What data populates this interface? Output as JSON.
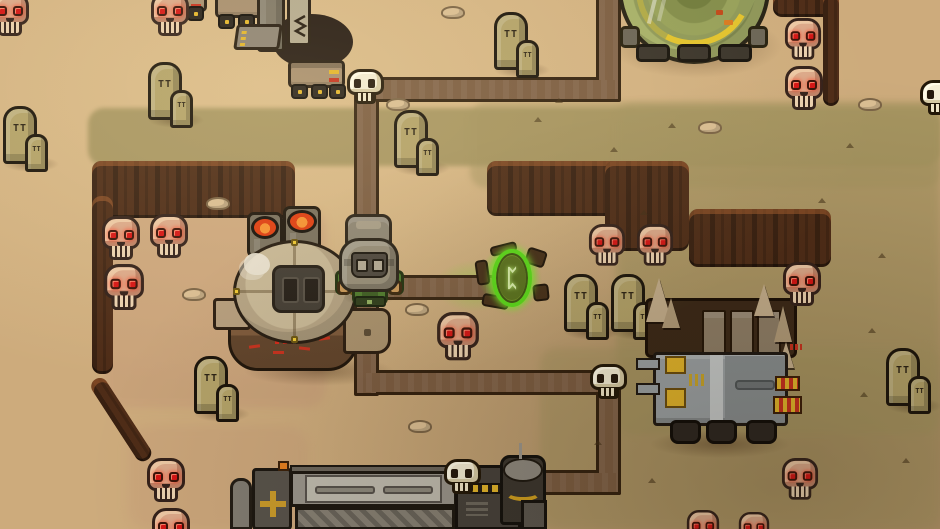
{
  "meta": {
    "width": 940,
    "height": 529
  },
  "palette": {
    "sand": "#cdab7c",
    "sand_hi": "#e2c491",
    "olive": "#a4935f",
    "pit": "#c59a78",
    "cliff": "#4e2c17",
    "cliff_edge": "#92542c",
    "path_fill": "#7b5c41",
    "path_edge": "#33210f",
    "bone": "#f3ecd4",
    "skull_pink": "#dba889",
    "skull_shade": "#bd8468",
    "skull_hi": "#ecc7a4",
    "eye_red": "#d41414",
    "outline": "#33211a",
    "stone": "#b2a168",
    "green_armor": "#4c7a2c",
    "glove": "#c89758",
    "helmet": "#958c78",
    "helmet_dark": "#4c463e",
    "lens": "#b2a995",
    "portal_green": "#58d818",
    "portal_mid": "#6f8c26",
    "portal_inner": "#57701c",
    "rune_pale": "#d6edaa",
    "rock_brown": "#432d17",
    "lava_red": "#dd3c10",
    "lava_orange": "#f59030",
    "yellow": "#e2b42a",
    "orange": "#e57f1f",
    "red_mark": "#c5301d",
    "tan_truck": "#a68d6e",
    "wheel": "#27211b",
    "metal": "#7e7666",
    "metal_light": "#b3a98f",
    "grey_cab": "#9aa0a3",
    "grey_light": "#c5c9c9",
    "grey_mid": "#878d8f",
    "bed_brown": "#3a2817",
    "plank": "#8d7d66",
    "spike_tan": "#c3ad8b",
    "dome_green": "#8e9858",
    "dome_light": "#a6b068",
    "tread": "#39332a",
    "factory_dark": "#57524a",
    "factory_panel": "#98938a",
    "factory_light": "#bdb9ad"
  },
  "portal": {
    "rune_glyph": "ᛈ"
  },
  "decor": {
    "gravestone_mark": "TT",
    "gravestone_mark_small": "TT"
  },
  "layout": {
    "mining-machine": {
      "x": 185,
      "y": 0
    },
    "dome-structure": {
      "x": 618,
      "y": -88
    },
    "incinerator-furnace": {
      "x": 213,
      "y": 203
    },
    "armored-truck": {
      "x": 638,
      "y": 292
    },
    "workshop-building": {
      "x": 228,
      "y": 455
    },
    "player-character": {
      "x": 331,
      "y": 212
    },
    "green-portal": {
      "x": 468,
      "y": 236
    }
  },
  "scene": {
    "terrain": {
      "olive_patches": [
        {
          "x": 88,
          "y": 108,
          "w": 852,
          "h": 58,
          "op": 0.92,
          "blur": 2
        },
        {
          "x": 470,
          "y": 102,
          "w": 470,
          "h": 86,
          "op": 0.5,
          "blur": 3
        },
        {
          "x": 616,
          "y": 104,
          "w": 324,
          "h": 330,
          "op": 0.68,
          "blur": 4
        },
        {
          "x": 540,
          "y": 348,
          "w": 400,
          "h": 181,
          "op": 0.5,
          "blur": 4
        }
      ],
      "pit_tints": [
        {
          "x": 104,
          "y": 208,
          "w": 222,
          "h": 200,
          "op": 0.5,
          "blur": 4
        },
        {
          "x": 128,
          "y": 426,
          "w": 180,
          "h": 103,
          "op": 0.35,
          "blur": 5
        }
      ],
      "cliffs": [
        {
          "x": 92,
          "y": 161,
          "w": 203,
          "h": 57
        },
        {
          "x": 92,
          "y": 196,
          "w": 21,
          "h": 178
        },
        {
          "x": 487,
          "y": 161,
          "w": 198,
          "h": 55
        },
        {
          "x": 605,
          "y": 161,
          "w": 84,
          "h": 90
        },
        {
          "x": 689,
          "y": 209,
          "w": 142,
          "h": 58
        },
        {
          "x": 773,
          "y": -8,
          "w": 66,
          "h": 25
        },
        {
          "x": 823,
          "y": -8,
          "w": 16,
          "h": 114
        },
        {
          "x": 88,
          "y": 384,
          "w": 17,
          "h": 96,
          "rot": -33
        }
      ],
      "shadows": [
        {
          "x": 610,
          "y": 14,
          "w": 172,
          "h": 64
        },
        {
          "x": 244,
          "y": 356,
          "w": 150,
          "h": 30
        },
        {
          "x": 650,
          "y": 430,
          "w": 140,
          "h": 28
        },
        {
          "x": 434,
          "y": 260,
          "w": 82,
          "h": 52,
          "grad": "radial-gradient(closest-side, rgba(116,226,38,0.40), rgba(116,226,38,0))"
        }
      ]
    },
    "paths": {
      "width": 19,
      "segments": [
        {
          "x": 599,
          "y": -6,
          "w": 19,
          "h": 101
        },
        {
          "x": 363,
          "y": 80,
          "w": 255,
          "h": 19
        },
        {
          "x": 357,
          "y": 88,
          "w": 19,
          "h": 305
        },
        {
          "x": 374,
          "y": 278,
          "w": 132,
          "h": 19
        },
        {
          "x": 366,
          "y": 373,
          "w": 252,
          "h": 19
        },
        {
          "x": 599,
          "y": 380,
          "w": 19,
          "h": 112
        },
        {
          "x": 462,
          "y": 473,
          "w": 156,
          "h": 19
        },
        {
          "x": 453,
          "y": 480,
          "w": 19,
          "h": 49
        }
      ],
      "nodes": [
        {
          "x": 347,
          "y": 69
        },
        {
          "x": 590,
          "y": 364
        },
        {
          "x": 444,
          "y": 459
        },
        {
          "x": 920,
          "y": 80
        }
      ]
    },
    "skulls": [
      {
        "x": 150,
        "y": -8
      },
      {
        "x": -10,
        "y": -8
      },
      {
        "x": 101,
        "y": 216
      },
      {
        "x": 149,
        "y": 214
      },
      {
        "x": 103,
        "y": 264,
        "s": 1.05
      },
      {
        "x": 146,
        "y": 458
      },
      {
        "x": 151,
        "y": 508
      },
      {
        "x": 436,
        "y": 312,
        "s": 1.1
      },
      {
        "x": 588,
        "y": 224,
        "s": 0.95
      },
      {
        "x": 636,
        "y": 224,
        "s": 0.95
      },
      {
        "x": 784,
        "y": 18,
        "s": 0.95
      },
      {
        "x": 784,
        "y": 66
      },
      {
        "x": 782,
        "y": 262
      },
      {
        "x": 781,
        "y": 458,
        "s": 0.95
      },
      {
        "x": 686,
        "y": 510,
        "s": 0.85
      },
      {
        "x": 738,
        "y": 512,
        "s": 0.8
      }
    ],
    "gravestones": [
      {
        "x": 3,
        "y": 106
      },
      {
        "x": 148,
        "y": 62
      },
      {
        "x": 394,
        "y": 110
      },
      {
        "x": 494,
        "y": 12
      },
      {
        "x": 564,
        "y": 274
      },
      {
        "x": 611,
        "y": 274
      },
      {
        "x": 886,
        "y": 348
      },
      {
        "x": 194,
        "y": 356
      }
    ],
    "pebbles": [
      {
        "x": 441,
        "y": 6
      },
      {
        "x": 386,
        "y": 98
      },
      {
        "x": 206,
        "y": 197
      },
      {
        "x": 405,
        "y": 303
      },
      {
        "x": 408,
        "y": 420
      },
      {
        "x": 182,
        "y": 288
      },
      {
        "x": 858,
        "y": 98
      },
      {
        "x": 698,
        "y": 121
      }
    ],
    "sprinkles": [
      {
        "x": 534,
        "y": 117
      },
      {
        "x": 610,
        "y": 147
      },
      {
        "x": 668,
        "y": 123
      },
      {
        "x": 700,
        "y": 312
      },
      {
        "x": 757,
        "y": 349
      },
      {
        "x": 846,
        "y": 143
      },
      {
        "x": 878,
        "y": 253
      },
      {
        "x": 902,
        "y": 458
      },
      {
        "x": 648,
        "y": 478
      },
      {
        "x": 718,
        "y": 418
      },
      {
        "x": 818,
        "y": 198
      },
      {
        "x": 868,
        "y": 328
      },
      {
        "x": 555,
        "y": 98
      },
      {
        "x": 640,
        "y": 210
      },
      {
        "x": 594,
        "y": 440
      },
      {
        "x": 860,
        "y": 392
      }
    ]
  }
}
